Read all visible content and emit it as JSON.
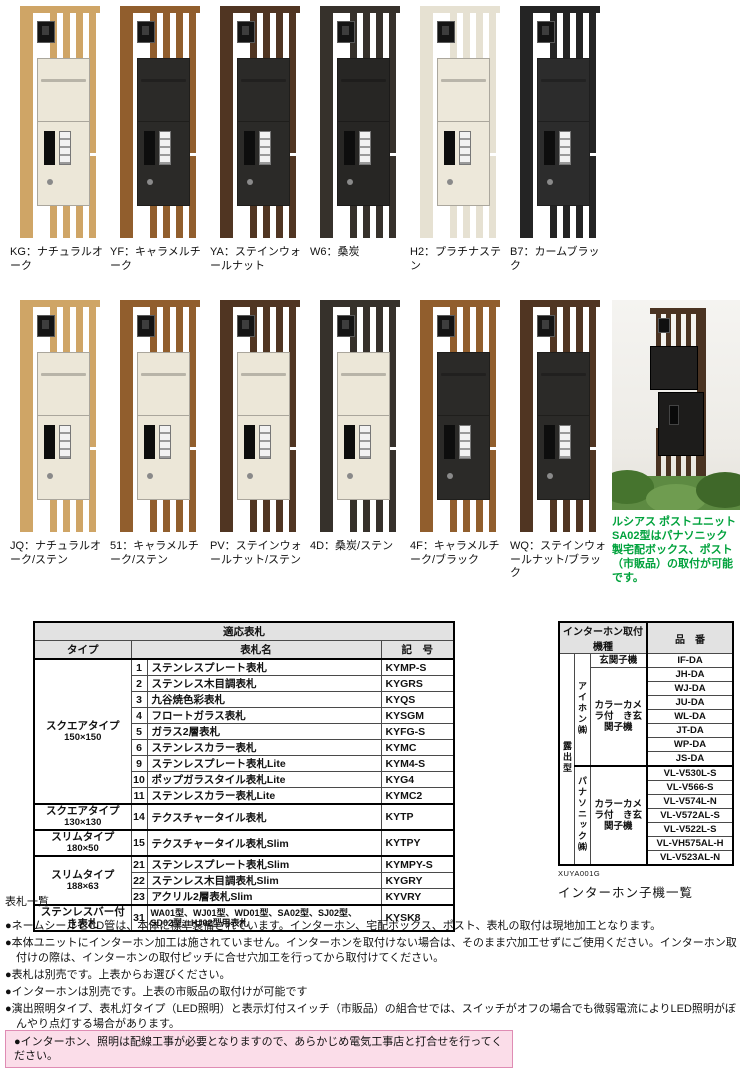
{
  "products": {
    "row1": [
      {
        "label": "KG：ナチュラルオーク",
        "frame": "#cfa566",
        "body": "#ece7d8"
      },
      {
        "label": "YF：キャラメルチーク",
        "frame": "#915e2d",
        "body": "#2b2a28"
      },
      {
        "label": "YA：ステインウォールナット",
        "frame": "#503522",
        "body": "#2b2a28"
      },
      {
        "label": "W6：桑炭",
        "frame": "#36312b",
        "body": "#272624"
      },
      {
        "label": "H2：プラチナステン",
        "frame": "#e6e1d2",
        "body": "#ede8da"
      },
      {
        "label": "B7：カームブラック",
        "frame": "#242424",
        "body": "#2c2c2c"
      }
    ],
    "row2": [
      {
        "label": "JQ：ナチュラルオーク/ステン",
        "frame": "#cfa566",
        "body": "#ece7d8"
      },
      {
        "label": "51：キャラメルチーク/ステン",
        "frame": "#915e2d",
        "body": "#ece7d8"
      },
      {
        "label": "PV：ステインウォールナット/ステン",
        "frame": "#503522",
        "body": "#ece7d8"
      },
      {
        "label": "4D：桑炭/ステン",
        "frame": "#36312b",
        "body": "#ece7d8"
      },
      {
        "label": "4F：キャラメルチーク/ブラック",
        "frame": "#915e2d",
        "body": "#2b2a28"
      },
      {
        "label": "WQ：ステインウォールナット/ブラック",
        "frame": "#503522",
        "body": "#2b2a28"
      }
    ]
  },
  "photo": {
    "caption": "ルシアス ポストユニットSA02型はパナソニック製宅配ボックス、ポスト（市販品）の取付が可能です。",
    "caption_color": "#00a23c"
  },
  "nameplate_table": {
    "title": "適応表札",
    "col_type": "タイプ",
    "col_name": "表札名",
    "col_code": "記　号",
    "groups": [
      {
        "type": "スクエアタイプ",
        "size": "150×150",
        "rows": [
          {
            "no": "1",
            "name": "ステンレスプレート表札",
            "code": "KYMP-S"
          },
          {
            "no": "2",
            "name": "ステンレス木目調表札",
            "code": "KYGRS"
          },
          {
            "no": "3",
            "name": "九谷焼色彩表札",
            "code": "KYQS"
          },
          {
            "no": "4",
            "name": "フロートガラス表札",
            "code": "KYSGM"
          },
          {
            "no": "5",
            "name": "ガラス2層表札",
            "code": "KYFG-S"
          },
          {
            "no": "6",
            "name": "ステンレスカラー表札",
            "code": "KYMC"
          },
          {
            "no": "9",
            "name": "ステンレスプレート表札Lite",
            "code": "KYM4-S"
          },
          {
            "no": "10",
            "name": "ポップガラスタイル表札Lite",
            "code": "KYG4"
          },
          {
            "no": "11",
            "name": "ステンレスカラー表札Lite",
            "code": "KYMC2"
          }
        ]
      },
      {
        "type": "スクエアタイプ",
        "size": "130×130",
        "rows": [
          {
            "no": "14",
            "name": "テクスチャータイル表札",
            "code": "KYTP"
          }
        ]
      },
      {
        "type": "スリムタイプ",
        "size": "180×50",
        "rows": [
          {
            "no": "15",
            "name": "テクスチャータイル表札Slim",
            "code": "KYTPY"
          }
        ]
      },
      {
        "type": "スリムタイプ",
        "size": "188×63",
        "rows": [
          {
            "no": "21",
            "name": "ステンレスプレート表札Slim",
            "code": "KYMPY-S"
          },
          {
            "no": "22",
            "name": "ステンレス木目調表札Slim",
            "code": "KYGRY"
          },
          {
            "no": "23",
            "name": "アクリル2層表札Slim",
            "code": "KYVRY"
          }
        ]
      },
      {
        "type": "ステンレスバー付き表札",
        "size": "",
        "rows": [
          {
            "no": "31",
            "name": "WA01型、WJ01型、WD01型、SA02型、SJ02型、SD02型、HJ02型用表札",
            "code": "KYSK8",
            "tall": true
          }
        ]
      }
    ]
  },
  "intercom_table": {
    "header_left": "インターホン取付機種",
    "header_right": "品　番",
    "mount": "露出型",
    "sections": [
      {
        "maker": "アイホン㈱",
        "groups": [
          {
            "label": "玄関子機",
            "models": [
              "IF-DA"
            ]
          },
          {
            "label": "カラーカメラ付　き玄関子機",
            "models": [
              "JH-DA",
              "WJ-DA",
              "JU-DA",
              "WL-DA",
              "JT-DA",
              "WP-DA",
              "JS-DA"
            ]
          }
        ]
      },
      {
        "maker": "パナソニック㈱",
        "groups": [
          {
            "label": "カラーカメラ付　き玄関子機",
            "models": [
              "VL-V530L-S",
              "VL-V566-S",
              "VL-V574L-N",
              "VL-V572AL-S",
              "VL-V522L-S",
              "VL-VH575AL-H",
              "VL-V523AL-N"
            ]
          }
        ]
      }
    ],
    "code": "XUYA001G",
    "caption": "インターホン子機一覧"
  },
  "notes": {
    "title": "表札一覧",
    "items": [
      "●ネームシールとCD管は、本体に標準装備されています。インターホン、宅配ボックス、ポスト、表札の取付は現地加工となります。",
      "●本体ユニットにインターホン加工は施されていません。インターホンを取付けない場合は、そのまま穴加工せずにご使用ください。インターホン取付けの際は、インターホンの取付ピッチに合せ穴加工を行ってから取付けてください。",
      "●表札は別売です。上表からお選びください。",
      "●インターホンは別売です。上表の市販品の取付けが可能です",
      "●演出照明タイプ、表札灯タイプ（LED照明）と表示灯付スイッチ（市販品）の組合せでは、スイッチがオフの場合でも微弱電流によりLED照明がぼんやり点灯する場合があります。",
      "●インターホンにより、本体の一部がカメラに映り込む場合があります。"
    ]
  },
  "warning": {
    "text": "●インターホン、照明は配線工事が必要となりますので、あらかじめ電気工事店と打合せを行ってください。",
    "bg": "#fbdde9",
    "border": "#df8cb4"
  }
}
